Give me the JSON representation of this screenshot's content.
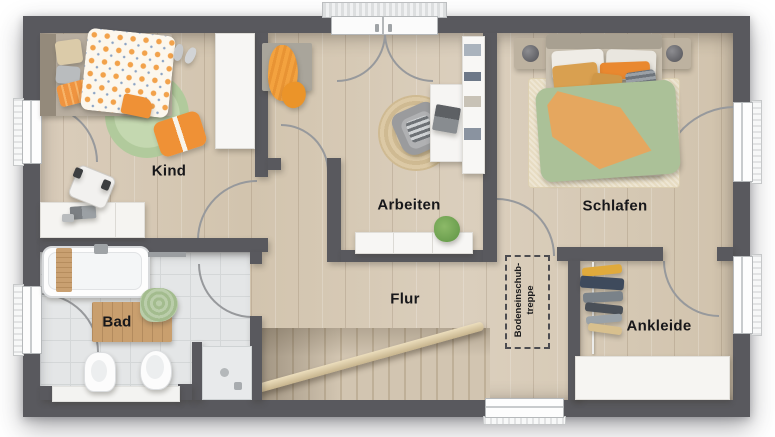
{
  "floorplan": {
    "type": "residential-upper-floor-plan",
    "rooms": [
      {
        "id": "kind",
        "label": "Kind",
        "furniture": [
          "single-bed",
          "polka-dot-duvet",
          "green-round-rug",
          "floor-cushion",
          "slippers",
          "wardrobe",
          "desk",
          "laptop",
          "office-chair"
        ]
      },
      {
        "id": "arbeiten",
        "label": "Arbeiten",
        "furniture": [
          "bench-with-blanket",
          "jute-round-rug",
          "armchair",
          "desk",
          "laptop",
          "bookshelf",
          "sideboard",
          "plant"
        ]
      },
      {
        "id": "schlafen",
        "label": "Schlafen",
        "furniture": [
          "double-bed",
          "nightstand-left",
          "nightstand-right",
          "lamps",
          "rug",
          "green-orange-duvet",
          "pillows"
        ]
      },
      {
        "id": "flur",
        "label": "Flur",
        "furniture": [
          "staircase",
          "handrail"
        ]
      },
      {
        "id": "bad",
        "label": "Bad",
        "furniture": [
          "bathtub",
          "bath-caddy",
          "towel-bar",
          "wood-mat",
          "green-towel",
          "bidet",
          "toilet",
          "vanity-counter",
          "shower"
        ]
      },
      {
        "id": "ankleide",
        "label": "Ankleide",
        "furniture": [
          "clothes-rail",
          "hanging-clothes",
          "dresser"
        ]
      }
    ],
    "attic_hatch": {
      "line1": "Bodeneinschub-",
      "line2": "treppe"
    },
    "openings": {
      "windows": [
        "kind-left",
        "bad-left",
        "schlafen-right",
        "ankleide-right",
        "flur-bottom"
      ],
      "doors": [
        "kind",
        "bad",
        "arbeiten",
        "schlafen",
        "ankleide",
        "balcony-double-door"
      ]
    },
    "colors": {
      "wall": "#59595e",
      "wood_floor": "#d8cbb8",
      "tile_floor": "#e4e6e7",
      "accent_orange": "#ef9440",
      "accent_green": "#aec49a",
      "jute": "#d8c5a0",
      "swing_arc": "#97999c",
      "label_text": "#17171a"
    }
  }
}
